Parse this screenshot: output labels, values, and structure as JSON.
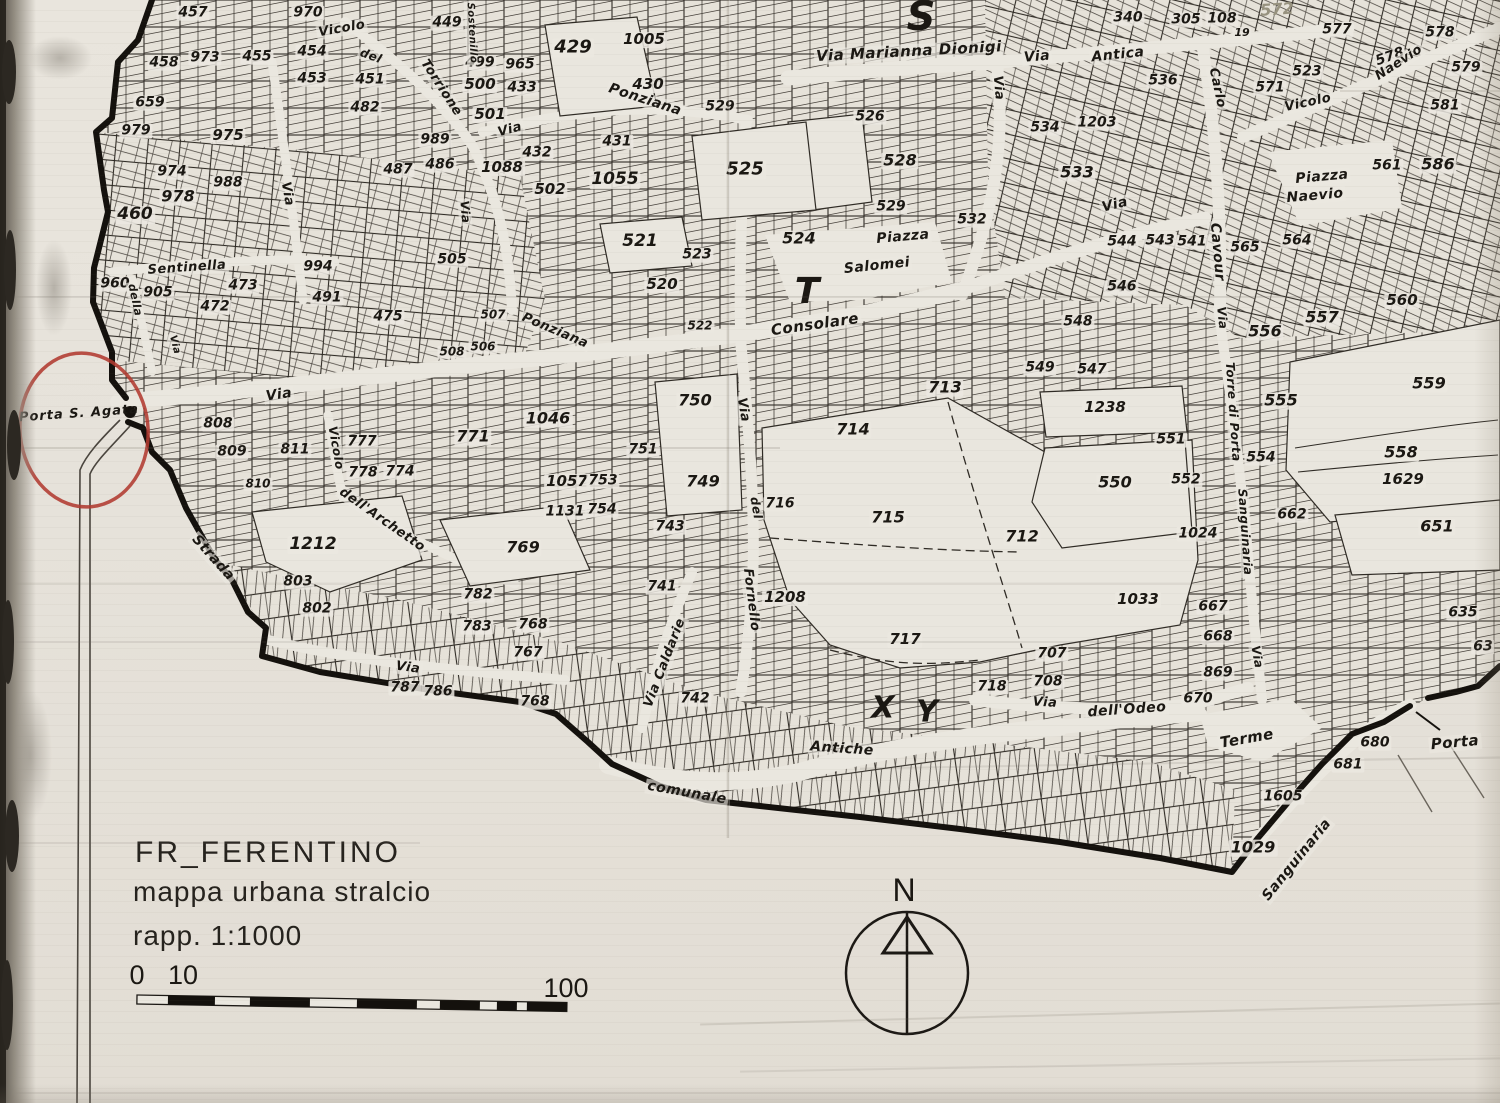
{
  "title_block": {
    "line1": "FR_FERENTINO",
    "line2": "mappa urbana stralcio",
    "line3": "rapp. 1:1000",
    "scale_tick_0": "0",
    "scale_tick_10": "10",
    "scale_tick_100": "100"
  },
  "compass": {
    "north_label": "N"
  },
  "annotation": {
    "label": "Porta S. Agata",
    "circle_color": "#b23a30"
  },
  "colors": {
    "ink": "#1b1813",
    "paper": "#e7e3db",
    "annotation_red": "#b23a30"
  },
  "map": {
    "parcels": [
      {
        "t": "457",
        "x": 193,
        "y": 13
      },
      {
        "t": "970",
        "x": 308,
        "y": 13
      },
      {
        "t": "449",
        "x": 447,
        "y": 23
      },
      {
        "t": "429",
        "x": 573,
        "y": 48,
        "s": 18
      },
      {
        "t": "1005",
        "x": 644,
        "y": 40,
        "s": 15
      },
      {
        "t": "430",
        "x": 648,
        "y": 85,
        "s": 15
      },
      {
        "t": "458",
        "x": 164,
        "y": 63
      },
      {
        "t": "973",
        "x": 205,
        "y": 58
      },
      {
        "t": "455",
        "x": 257,
        "y": 57
      },
      {
        "t": "454",
        "x": 312,
        "y": 52
      },
      {
        "t": "453",
        "x": 312,
        "y": 79
      },
      {
        "t": "451",
        "x": 370,
        "y": 80
      },
      {
        "t": "482",
        "x": 365,
        "y": 108
      },
      {
        "t": "659",
        "x": 150,
        "y": 103
      },
      {
        "t": "979",
        "x": 136,
        "y": 131
      },
      {
        "t": "975",
        "x": 228,
        "y": 136,
        "s": 15
      },
      {
        "t": "974",
        "x": 172,
        "y": 172
      },
      {
        "t": "988",
        "x": 228,
        "y": 183
      },
      {
        "t": "978",
        "x": 178,
        "y": 197,
        "s": 16
      },
      {
        "t": "460",
        "x": 135,
        "y": 215,
        "s": 17
      },
      {
        "t": "989",
        "x": 435,
        "y": 140
      },
      {
        "t": "487",
        "x": 398,
        "y": 170
      },
      {
        "t": "486",
        "x": 440,
        "y": 165
      },
      {
        "t": "505",
        "x": 452,
        "y": 260
      },
      {
        "t": "499",
        "x": 480,
        "y": 63
      },
      {
        "t": "965",
        "x": 520,
        "y": 65
      },
      {
        "t": "500",
        "x": 480,
        "y": 85,
        "s": 15
      },
      {
        "t": "433",
        "x": 522,
        "y": 88
      },
      {
        "t": "501",
        "x": 490,
        "y": 115,
        "s": 15
      },
      {
        "t": "432",
        "x": 537,
        "y": 153
      },
      {
        "t": "1088",
        "x": 502,
        "y": 168,
        "s": 15
      },
      {
        "t": "502",
        "x": 550,
        "y": 190,
        "s": 15
      },
      {
        "t": "431",
        "x": 617,
        "y": 142
      },
      {
        "t": "1055",
        "x": 615,
        "y": 180,
        "s": 17
      },
      {
        "t": "521",
        "x": 640,
        "y": 242,
        "s": 17
      },
      {
        "t": "523",
        "x": 697,
        "y": 255
      },
      {
        "t": "520",
        "x": 662,
        "y": 285,
        "s": 15
      },
      {
        "t": "525",
        "x": 745,
        "y": 170,
        "s": 18
      },
      {
        "t": "529",
        "x": 720,
        "y": 107
      },
      {
        "t": "522",
        "x": 700,
        "y": 326,
        "s": 12
      },
      {
        "t": "960",
        "x": 115,
        "y": 284
      },
      {
        "t": "905",
        "x": 158,
        "y": 293
      },
      {
        "t": "473",
        "x": 243,
        "y": 286
      },
      {
        "t": "472",
        "x": 215,
        "y": 307
      },
      {
        "t": "994",
        "x": 318,
        "y": 267
      },
      {
        "t": "491",
        "x": 327,
        "y": 298
      },
      {
        "t": "475",
        "x": 388,
        "y": 317
      },
      {
        "t": "507",
        "x": 493,
        "y": 315,
        "s": 12
      },
      {
        "t": "508",
        "x": 452,
        "y": 352,
        "s": 12
      },
      {
        "t": "506",
        "x": 483,
        "y": 347,
        "s": 12
      },
      {
        "t": "808",
        "x": 218,
        "y": 424
      },
      {
        "t": "809",
        "x": 232,
        "y": 452
      },
      {
        "t": "811",
        "x": 295,
        "y": 450
      },
      {
        "t": "810",
        "x": 258,
        "y": 484,
        "s": 12
      },
      {
        "t": "1212",
        "x": 313,
        "y": 545,
        "s": 17
      },
      {
        "t": "803",
        "x": 298,
        "y": 582
      },
      {
        "t": "802",
        "x": 317,
        "y": 609
      },
      {
        "t": "777",
        "x": 362,
        "y": 442
      },
      {
        "t": "778",
        "x": 363,
        "y": 473
      },
      {
        "t": "774",
        "x": 400,
        "y": 472
      },
      {
        "t": "771",
        "x": 473,
        "y": 437,
        "s": 16
      },
      {
        "t": "1046",
        "x": 548,
        "y": 419,
        "s": 16
      },
      {
        "t": "750",
        "x": 695,
        "y": 401,
        "s": 16
      },
      {
        "t": "751",
        "x": 643,
        "y": 450
      },
      {
        "t": "1057",
        "x": 567,
        "y": 482,
        "s": 15
      },
      {
        "t": "753",
        "x": 603,
        "y": 481
      },
      {
        "t": "749",
        "x": 703,
        "y": 482,
        "s": 16
      },
      {
        "t": "1131",
        "x": 565,
        "y": 512
      },
      {
        "t": "754",
        "x": 602,
        "y": 510
      },
      {
        "t": "743",
        "x": 670,
        "y": 527
      },
      {
        "t": "769",
        "x": 523,
        "y": 548,
        "s": 16
      },
      {
        "t": "716",
        "x": 780,
        "y": 504
      },
      {
        "t": "714",
        "x": 853,
        "y": 430,
        "s": 16
      },
      {
        "t": "715",
        "x": 888,
        "y": 518,
        "s": 16
      },
      {
        "t": "713",
        "x": 945,
        "y": 388,
        "s": 16
      },
      {
        "t": "712",
        "x": 1022,
        "y": 537,
        "s": 16
      },
      {
        "t": "717",
        "x": 905,
        "y": 640,
        "s": 15
      },
      {
        "t": "1033",
        "x": 1138,
        "y": 600,
        "s": 15
      },
      {
        "t": "782",
        "x": 478,
        "y": 595
      },
      {
        "t": "783",
        "x": 477,
        "y": 627
      },
      {
        "t": "768",
        "x": 533,
        "y": 625
      },
      {
        "t": "767",
        "x": 528,
        "y": 653
      },
      {
        "t": "787",
        "x": 405,
        "y": 688
      },
      {
        "t": "786",
        "x": 438,
        "y": 692
      },
      {
        "t": "768",
        "x": 535,
        "y": 702
      },
      {
        "t": "741",
        "x": 662,
        "y": 587
      },
      {
        "t": "1208",
        "x": 785,
        "y": 598,
        "s": 15
      },
      {
        "t": "742",
        "x": 695,
        "y": 699
      },
      {
        "t": "707",
        "x": 1052,
        "y": 654
      },
      {
        "t": "708",
        "x": 1048,
        "y": 682
      },
      {
        "t": "718",
        "x": 992,
        "y": 687
      },
      {
        "t": "667",
        "x": 1213,
        "y": 607
      },
      {
        "t": "668",
        "x": 1218,
        "y": 637
      },
      {
        "t": "869",
        "x": 1218,
        "y": 673
      },
      {
        "t": "670",
        "x": 1198,
        "y": 699
      },
      {
        "t": "635",
        "x": 1463,
        "y": 613
      },
      {
        "t": "63",
        "x": 1483,
        "y": 647
      },
      {
        "t": "680",
        "x": 1375,
        "y": 743
      },
      {
        "t": "681",
        "x": 1348,
        "y": 765
      },
      {
        "t": "1605",
        "x": 1283,
        "y": 797
      },
      {
        "t": "1029",
        "x": 1253,
        "y": 848,
        "s": 16
      },
      {
        "t": "546",
        "x": 1120,
        "y": 288
      },
      {
        "t": "548",
        "x": 1078,
        "y": 322
      },
      {
        "t": "549",
        "x": 1040,
        "y": 368
      },
      {
        "t": "547",
        "x": 1092,
        "y": 370
      },
      {
        "t": "1238",
        "x": 1105,
        "y": 408,
        "s": 15
      },
      {
        "t": "556",
        "x": 1265,
        "y": 332,
        "s": 16
      },
      {
        "t": "557",
        "x": 1322,
        "y": 318,
        "s": 16
      },
      {
        "t": "560",
        "x": 1402,
        "y": 301,
        "s": 15
      },
      {
        "t": "555",
        "x": 1281,
        "y": 401,
        "s": 16
      },
      {
        "t": "551",
        "x": 1171,
        "y": 440
      },
      {
        "t": "554",
        "x": 1261,
        "y": 458
      },
      {
        "t": "550",
        "x": 1115,
        "y": 483,
        "s": 16
      },
      {
        "t": "552",
        "x": 1186,
        "y": 480
      },
      {
        "t": "1024",
        "x": 1198,
        "y": 534
      },
      {
        "t": "662",
        "x": 1292,
        "y": 515
      },
      {
        "t": "559",
        "x": 1429,
        "y": 384,
        "s": 16
      },
      {
        "t": "558",
        "x": 1401,
        "y": 453,
        "s": 16
      },
      {
        "t": "1629",
        "x": 1403,
        "y": 480,
        "s": 15
      },
      {
        "t": "651",
        "x": 1437,
        "y": 527,
        "s": 16
      },
      {
        "t": "526",
        "x": 870,
        "y": 117
      },
      {
        "t": "528",
        "x": 900,
        "y": 161,
        "s": 16
      },
      {
        "t": "529",
        "x": 891,
        "y": 207
      },
      {
        "t": "532",
        "x": 972,
        "y": 220
      },
      {
        "t": "524",
        "x": 799,
        "y": 239,
        "s": 16
      },
      {
        "t": "534",
        "x": 1045,
        "y": 128
      },
      {
        "t": "1203",
        "x": 1097,
        "y": 123
      },
      {
        "t": "533",
        "x": 1077,
        "y": 173,
        "s": 16
      },
      {
        "t": "544",
        "x": 1122,
        "y": 242
      },
      {
        "t": "543",
        "x": 1160,
        "y": 241
      },
      {
        "t": "541",
        "x": 1192,
        "y": 242
      },
      {
        "t": "546",
        "x": 1122,
        "y": 287
      },
      {
        "t": "565",
        "x": 1245,
        "y": 248
      },
      {
        "t": "564",
        "x": 1297,
        "y": 241
      },
      {
        "t": "536",
        "x": 1163,
        "y": 81
      },
      {
        "t": "577",
        "x": 1337,
        "y": 30
      },
      {
        "t": "578",
        "x": 1440,
        "y": 33
      },
      {
        "t": "578",
        "x": 1390,
        "y": 57,
        "r": -20
      },
      {
        "t": "579",
        "x": 1466,
        "y": 68
      },
      {
        "t": "581",
        "x": 1445,
        "y": 106
      },
      {
        "t": "523",
        "x": 1307,
        "y": 72
      },
      {
        "t": "571",
        "x": 1270,
        "y": 88
      },
      {
        "t": "561",
        "x": 1387,
        "y": 166
      },
      {
        "t": "586",
        "x": 1438,
        "y": 165,
        "s": 16
      },
      {
        "t": "340",
        "x": 1128,
        "y": 18
      },
      {
        "t": "305",
        "x": 1186,
        "y": 20
      },
      {
        "t": "108",
        "x": 1222,
        "y": 19
      },
      {
        "t": "19",
        "x": 1242,
        "y": 33,
        "s": 11
      }
    ],
    "streets": [
      {
        "t": "Vicolo",
        "x": 342,
        "y": 29,
        "r": -10,
        "s": 13
      },
      {
        "t": "del",
        "x": 371,
        "y": 56,
        "r": 20,
        "s": 12
      },
      {
        "t": "Torrione",
        "x": 441,
        "y": 88,
        "r": 57,
        "s": 13
      },
      {
        "t": "Sostenillo",
        "x": 471,
        "y": 33,
        "r": 87,
        "s": 10
      },
      {
        "t": "Via",
        "x": 287,
        "y": 194,
        "r": 80,
        "s": 13
      },
      {
        "t": "Via",
        "x": 465,
        "y": 212,
        "r": 85,
        "s": 12
      },
      {
        "t": "Via",
        "x": 510,
        "y": 130,
        "r": -15,
        "s": 13
      },
      {
        "t": "Ponziana",
        "x": 645,
        "y": 100,
        "r": 18,
        "s": 14
      },
      {
        "t": "Ponziana",
        "x": 555,
        "y": 331,
        "r": 23,
        "s": 13
      },
      {
        "t": "Consolare",
        "x": 815,
        "y": 325,
        "r": -8,
        "s": 15
      },
      {
        "t": "Via",
        "x": 743,
        "y": 410,
        "r": 80,
        "s": 13
      },
      {
        "t": "del",
        "x": 756,
        "y": 508,
        "r": 80,
        "s": 12
      },
      {
        "t": "Fornello",
        "x": 751,
        "y": 600,
        "r": 83,
        "s": 13
      },
      {
        "t": "Sentinella",
        "x": 187,
        "y": 268,
        "r": -4,
        "s": 13
      },
      {
        "t": "della",
        "x": 135,
        "y": 300,
        "r": 78,
        "s": 11
      },
      {
        "t": "Via",
        "x": 174,
        "y": 345,
        "r": 75,
        "s": 10
      },
      {
        "t": "Via",
        "x": 279,
        "y": 395,
        "r": -8,
        "s": 14
      },
      {
        "t": "Strada",
        "x": 213,
        "y": 558,
        "r": 48,
        "s": 14
      },
      {
        "t": "dell'Archetto",
        "x": 382,
        "y": 520,
        "r": 35,
        "s": 13
      },
      {
        "t": "Vicolo",
        "x": 336,
        "y": 448,
        "r": 80,
        "s": 12
      },
      {
        "t": "Via",
        "x": 408,
        "y": 668,
        "r": 8,
        "s": 13
      },
      {
        "t": "Via Caldarie",
        "x": 665,
        "y": 663,
        "r": -69,
        "s": 13
      },
      {
        "t": "Antiche",
        "x": 842,
        "y": 749,
        "r": 4,
        "s": 14
      },
      {
        "t": "comunale",
        "x": 687,
        "y": 793,
        "r": 10,
        "s": 14
      },
      {
        "t": "Via",
        "x": 1045,
        "y": 703,
        "r": 3,
        "s": 13
      },
      {
        "t": "dell'Odeo",
        "x": 1127,
        "y": 710,
        "r": -4,
        "s": 14
      },
      {
        "t": "Terme",
        "x": 1247,
        "y": 739,
        "r": -10,
        "s": 15
      },
      {
        "t": "Sanguinaria",
        "x": 1297,
        "y": 860,
        "r": -51,
        "s": 14
      },
      {
        "t": "Via",
        "x": 1257,
        "y": 657,
        "r": 80,
        "s": 12
      },
      {
        "t": "Via",
        "x": 1222,
        "y": 318,
        "r": 84,
        "s": 12
      },
      {
        "t": "Torre di Porta",
        "x": 1233,
        "y": 412,
        "r": 86,
        "s": 12
      },
      {
        "t": "Sanguinaria",
        "x": 1245,
        "y": 532,
        "r": 86,
        "s": 12
      },
      {
        "t": "Via Marianna Dionigi",
        "x": 909,
        "y": 52,
        "r": -3,
        "s": 15
      },
      {
        "t": "Via",
        "x": 1037,
        "y": 57,
        "r": -5,
        "s": 14
      },
      {
        "t": "Antica",
        "x": 1118,
        "y": 55,
        "r": -6,
        "s": 14
      },
      {
        "t": "Vicolo",
        "x": 1308,
        "y": 103,
        "r": -12,
        "s": 13
      },
      {
        "t": "Naevio",
        "x": 1399,
        "y": 63,
        "r": -33,
        "s": 13
      },
      {
        "t": "Piazza",
        "x": 1322,
        "y": 177,
        "r": -5,
        "s": 14
      },
      {
        "t": "Naevio",
        "x": 1315,
        "y": 196,
        "r": -5,
        "s": 14
      },
      {
        "t": "Via",
        "x": 998,
        "y": 88,
        "r": 85,
        "s": 13
      },
      {
        "t": "Via",
        "x": 1115,
        "y": 205,
        "r": -14,
        "s": 14
      },
      {
        "t": "Piazza",
        "x": 903,
        "y": 237,
        "r": -5,
        "s": 14
      },
      {
        "t": "Salomei",
        "x": 877,
        "y": 266,
        "r": -6,
        "s": 14
      },
      {
        "t": "Carlo",
        "x": 1217,
        "y": 88,
        "r": 78,
        "s": 13
      },
      {
        "t": "Cavour",
        "x": 1217,
        "y": 252,
        "r": 85,
        "s": 14
      },
      {
        "t": "Porta",
        "x": 1455,
        "y": 743,
        "r": -5,
        "s": 15
      }
    ],
    "letters": [
      {
        "t": "S",
        "x": 921,
        "y": 17,
        "s": 40
      },
      {
        "t": "T",
        "x": 807,
        "y": 292,
        "s": 36
      },
      {
        "t": "X",
        "x": 883,
        "y": 708,
        "s": 30
      },
      {
        "t": "Y",
        "x": 927,
        "y": 712,
        "s": 30
      },
      {
        "t": "572",
        "x": 1277,
        "y": 10,
        "s": 16,
        "r": -4,
        "k": "faint"
      }
    ]
  }
}
